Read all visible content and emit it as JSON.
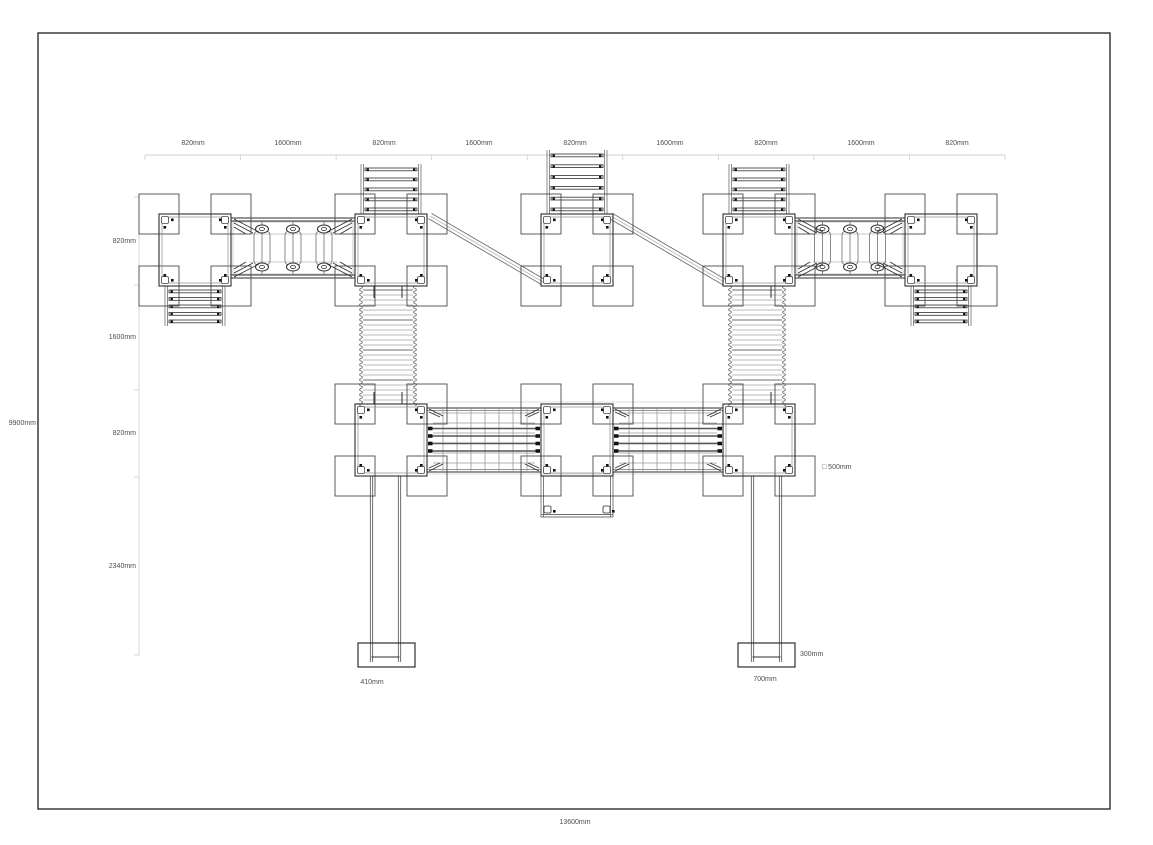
{
  "drawing": {
    "title": "site-plan-technical-drawing",
    "colors": {
      "border": "#3a3a3a",
      "line_dark": "#2e2e2e",
      "line_mid": "#6f6f6f",
      "line_light": "#b9b9b9",
      "line_xlight": "#d0d0d0",
      "label": "#4d4d4d",
      "background": "#ffffff"
    }
  },
  "dimensions": {
    "top": {
      "labels": [
        "820mm",
        "1600mm",
        "820mm",
        "1600mm",
        "820mm",
        "1600mm",
        "820mm",
        "1600mm",
        "820mm"
      ]
    },
    "left": {
      "labels": [
        "820mm",
        "1600mm",
        "820mm",
        "2340mm"
      ],
      "overall": "9900mm"
    },
    "bottom": {
      "overall": "13600mm"
    },
    "callouts": {
      "post_square": "□ 500mm",
      "footing_left_width": "410mm",
      "footing_right_width": "700mm",
      "footing_right_depth": "300mm"
    }
  },
  "structure": {
    "border": {
      "x": 38,
      "y": 33,
      "w": 1072,
      "h": 776
    },
    "dim_top_line": {
      "y": 155,
      "x1": 145,
      "x2": 1005,
      "segments": 9
    },
    "dim_left_line": {
      "x": 139,
      "ticks": [
        197,
        285,
        390,
        477,
        655
      ]
    },
    "towers": [
      {
        "id": "tower-top-1",
        "x": 159,
        "y": 214
      },
      {
        "id": "tower-top-2",
        "x": 355,
        "y": 214
      },
      {
        "id": "tower-top-3",
        "x": 541,
        "y": 214
      },
      {
        "id": "tower-top-4",
        "x": 723,
        "y": 214
      },
      {
        "id": "tower-top-5",
        "x": 905,
        "y": 214
      },
      {
        "id": "tower-mid-1",
        "x": 355,
        "y": 404
      },
      {
        "id": "tower-mid-2",
        "x": 541,
        "y": 404
      },
      {
        "id": "tower-mid-3",
        "x": 723,
        "y": 404
      }
    ],
    "tower_size": 72,
    "pad_size": 40,
    "plank_bridges": [
      {
        "x1": 231,
        "x2": 355,
        "cy": 248
      },
      {
        "x1": 795,
        "x2": 905,
        "cy": 248
      }
    ],
    "net_bridges": [
      {
        "x1": 427,
        "x2": 541,
        "y1": 404,
        "y2": 476
      },
      {
        "x1": 613,
        "x2": 723,
        "y1": 404,
        "y2": 476
      }
    ],
    "wavy_bridges": [
      {
        "cx": 388,
        "y1": 286,
        "y2": 404
      },
      {
        "cx": 757,
        "y1": 286,
        "y2": 404
      }
    ],
    "ladders": [
      {
        "cx": 195,
        "y1": 286,
        "y2": 326,
        "rungs": 5
      },
      {
        "cx": 391,
        "y1": 164,
        "y2": 214,
        "rungs": 5
      },
      {
        "cx": 577,
        "y1": 150,
        "y2": 214,
        "rungs": 6
      },
      {
        "cx": 759,
        "y1": 164,
        "y2": 214,
        "rungs": 5
      },
      {
        "cx": 941,
        "y1": 286,
        "y2": 326,
        "rungs": 5
      }
    ],
    "diagonals": [
      {
        "x1": 430,
        "y1": 216,
        "x2": 543,
        "y2": 282
      },
      {
        "x1": 611,
        "y1": 216,
        "x2": 724,
        "y2": 282
      }
    ],
    "slide_poles": [
      {
        "px1": 371.5,
        "px2": 399.5,
        "ytop": 476,
        "ybot": 662,
        "foot": {
          "x": 358,
          "y": 643,
          "w": 57,
          "h": 24
        }
      },
      {
        "px1": 752.5,
        "px2": 780.5,
        "ytop": 476,
        "ybot": 662,
        "foot": {
          "x": 738,
          "y": 643,
          "w": 57,
          "h": 24
        }
      }
    ],
    "extension": {
      "x1": 541,
      "x2": 613,
      "y1": 476,
      "y2": 517
    },
    "mid_rails": {
      "x1": 427,
      "x2": 723,
      "ytop": 402,
      "ybot": 474
    }
  }
}
